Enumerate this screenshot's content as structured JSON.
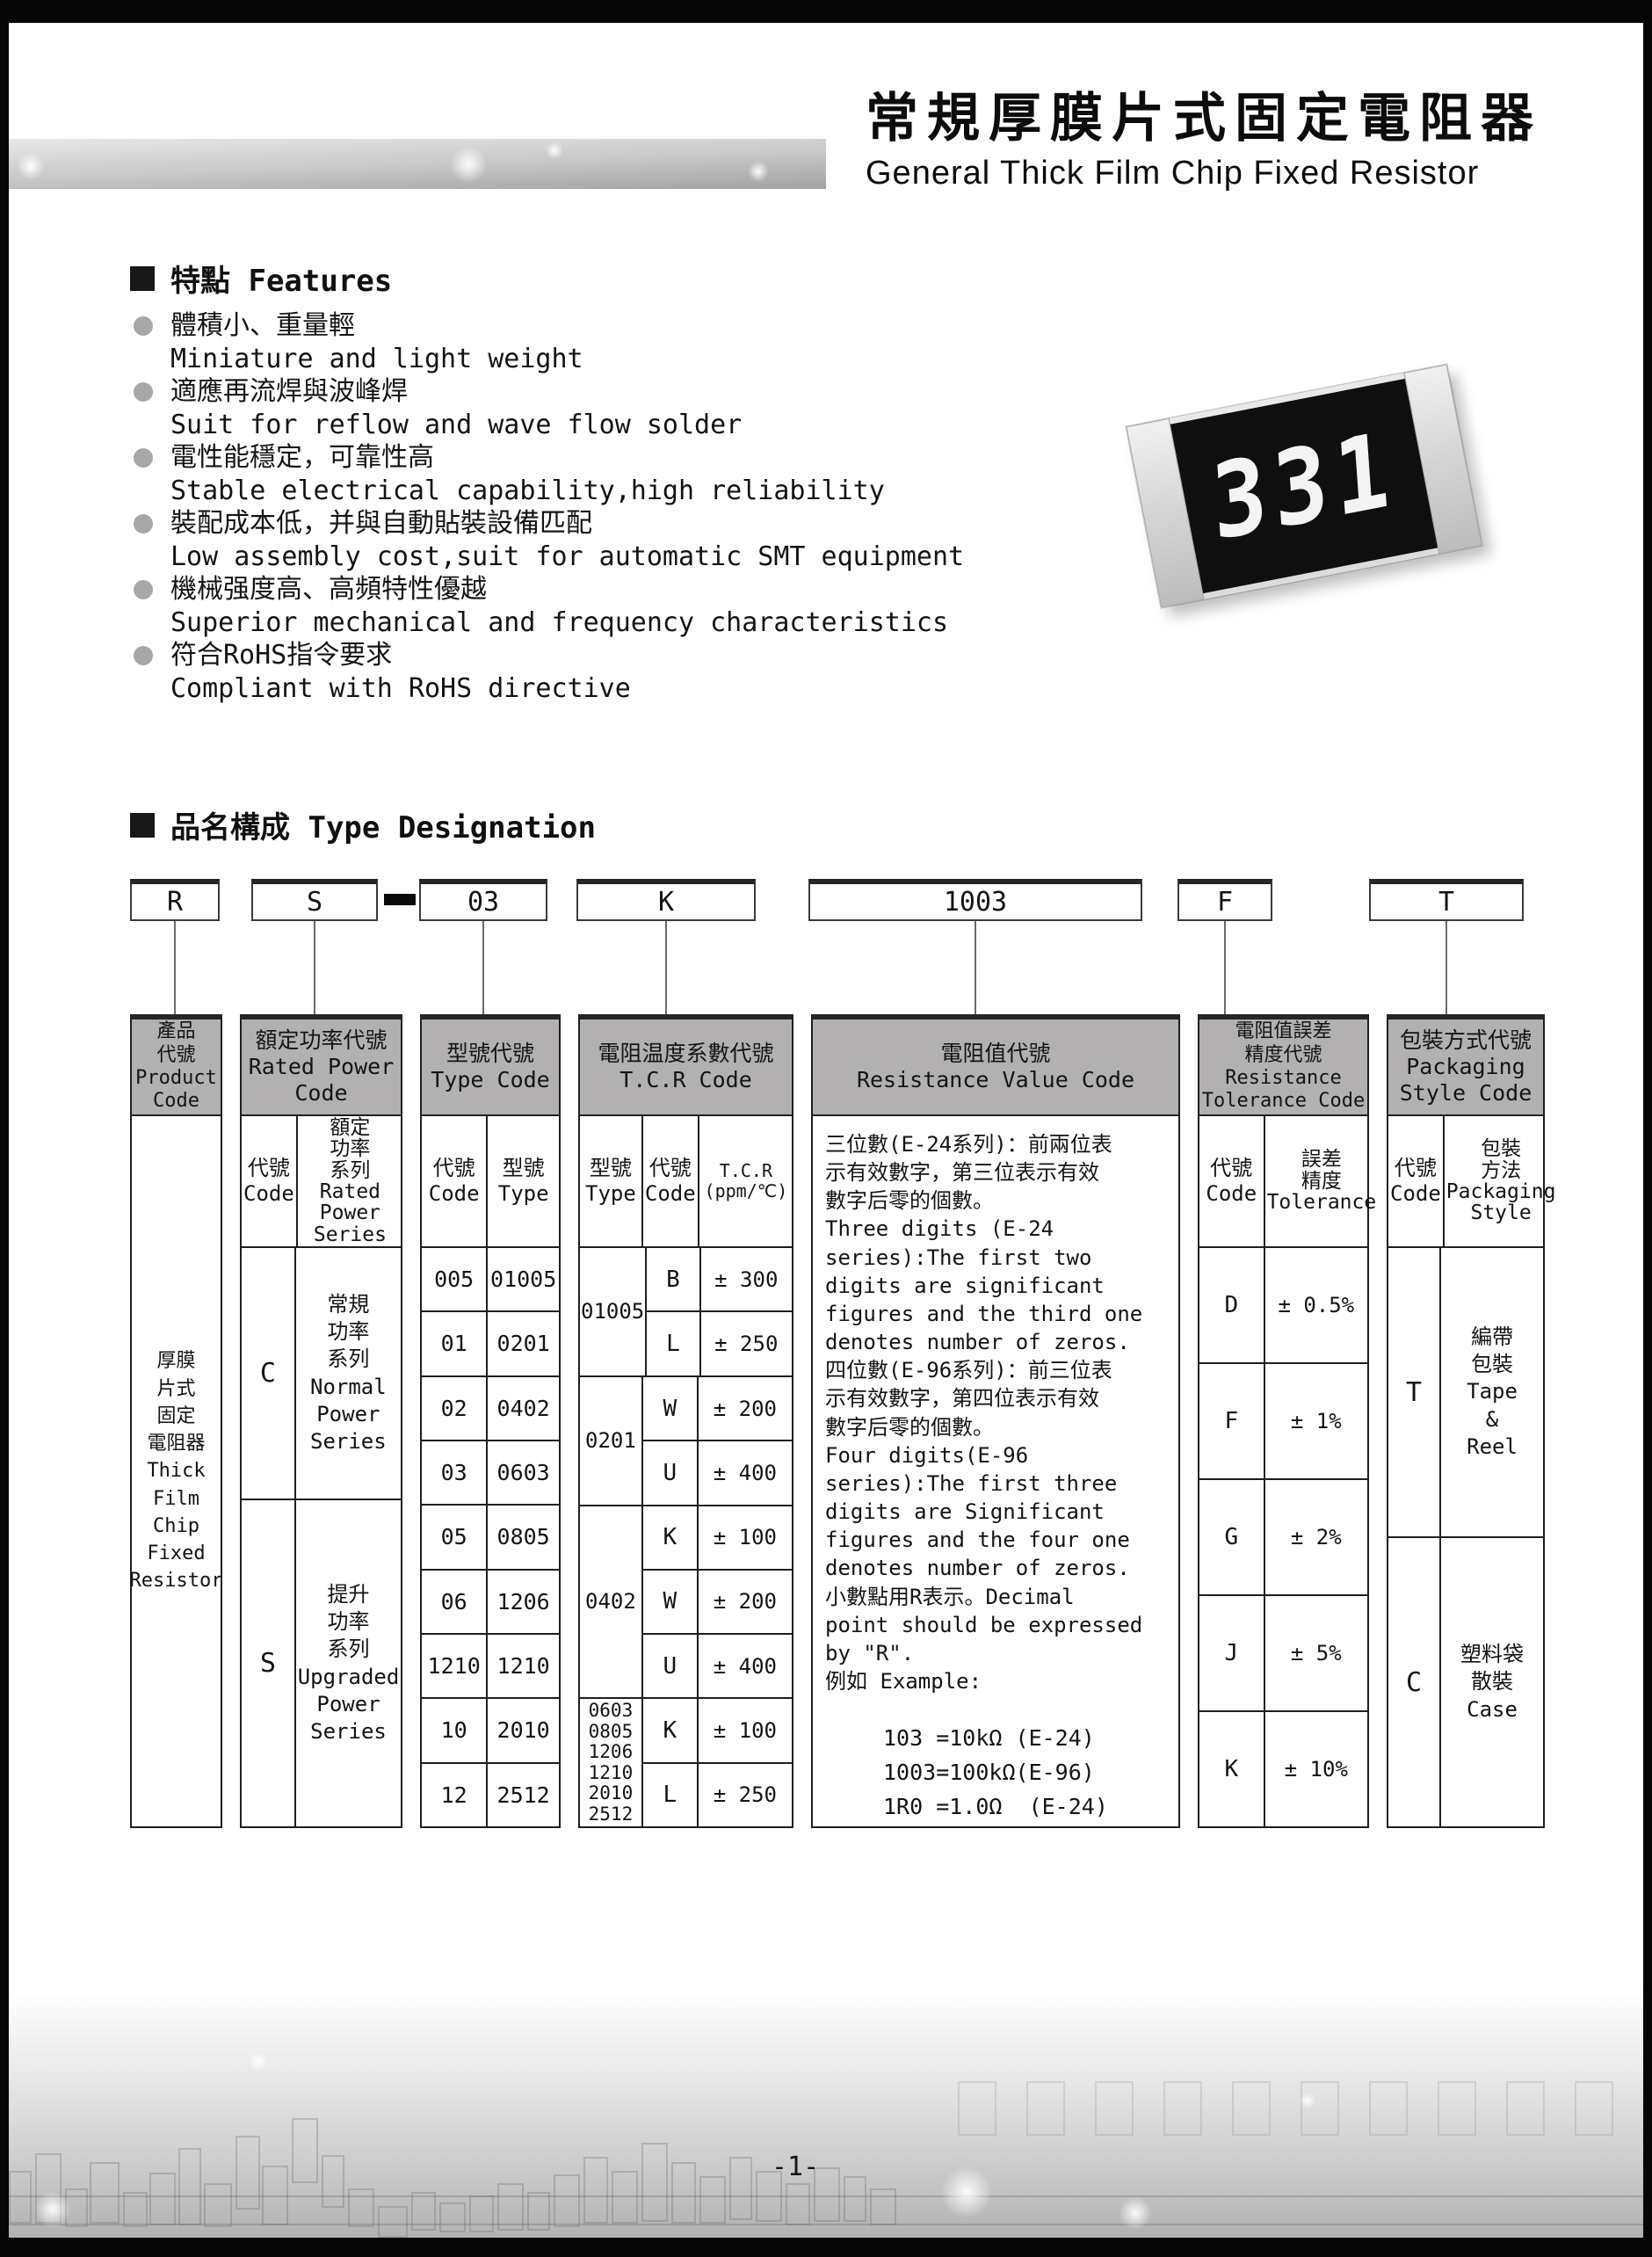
{
  "header": {
    "title_zh": "常規厚膜片式固定電阻器",
    "title_en": "General Thick Film Chip Fixed Resistor"
  },
  "features": {
    "title": "特點 Features",
    "items": [
      {
        "zh": "體積小、重量輕",
        "en": "Miniature and light weight"
      },
      {
        "zh": "適應再流焊與波峰焊",
        "en": "Suit for reflow and wave flow solder"
      },
      {
        "zh": "電性能穩定，可靠性高",
        "en": "Stable electrical capability,high reliability"
      },
      {
        "zh": "裝配成本低，并與自動貼裝設備匹配",
        "en": "Low assembly cost,suit for automatic SMT equipment"
      },
      {
        "zh": "機械强度高、高頻特性優越",
        "en": "Superior mechanical and frequency characteristics"
      },
      {
        "zh": "符合RoHS指令要求",
        "en": "Compliant with RoHS directive"
      }
    ]
  },
  "chip": {
    "marking": "331"
  },
  "designation": {
    "title": "品名構成  Type Designation",
    "codes": {
      "product": "R",
      "power": "S",
      "type": "03",
      "tcr": "K",
      "value": "1003",
      "tolerance": "F",
      "packaging": "T"
    }
  },
  "table": {
    "product": {
      "header": "產品\n代號\nProduct\nCode",
      "body": "厚膜\n片式\n固定\n電阻器\nThick\nFilm\nChip\nFixed\nResistor"
    },
    "power": {
      "header": "額定功率代號\nRated Power\nCode",
      "sub_code": "代號\nCode",
      "sub_series": "額定\n功率\n系列\nRated\nPower\nSeries",
      "rows": [
        {
          "code": "C",
          "series": "常規\n功率\n系列\nNormal\nPower\nSeries"
        },
        {
          "code": "S",
          "series": "提升\n功率\n系列\nUpgraded\nPower\nSeries"
        }
      ]
    },
    "type": {
      "header": "型號代號\nType Code",
      "sub_code": "代號\nCode",
      "sub_type": "型號\nType",
      "rows": [
        [
          "005",
          "01005"
        ],
        [
          "01",
          "0201"
        ],
        [
          "02",
          "0402"
        ],
        [
          "03",
          "0603"
        ],
        [
          "05",
          "0805"
        ],
        [
          "06",
          "1206"
        ],
        [
          "1210",
          "1210"
        ],
        [
          "10",
          "2010"
        ],
        [
          "12",
          "2512"
        ]
      ]
    },
    "tcr": {
      "header": "電阻温度系數代號\nT.C.R Code",
      "sub_type": "型號\nType",
      "sub_code": "代號\nCode",
      "sub_value": "T.C.R\n(ppm/℃)",
      "groups": [
        {
          "type": "01005",
          "rows": [
            [
              "B",
              "± 300"
            ],
            [
              "L",
              "± 250"
            ]
          ]
        },
        {
          "type": "0201",
          "rows": [
            [
              "W",
              "± 200"
            ],
            [
              "U",
              "± 400"
            ]
          ]
        },
        {
          "type": "0402",
          "rows": [
            [
              "K",
              "± 100"
            ],
            [
              "W",
              "± 200"
            ],
            [
              "U",
              "± 400"
            ]
          ]
        },
        {
          "type": "0603\n0805\n1206\n1210\n2010\n2512",
          "rows": [
            [
              "K",
              "± 100"
            ],
            [
              "L",
              "± 250"
            ]
          ]
        }
      ]
    },
    "value": {
      "header": "電阻值代號\nResistance Value Code",
      "text": "三位數(E-24系列)：前兩位表\n示有效數字，第三位表示有效\n數字后零的個數。\nThree digits (E-24\nseries):The first two\ndigits are significant\nfigures and the third one\ndenotes number of zeros.\n四位數(E-96系列)：前三位表\n示有效數字，第四位表示有效\n數字后零的個數。\nFour digits(E-96\nseries):The first three\ndigits are Significant\nfigures and the four one\ndenotes number of zeros.\n小數點用R表示。Decimal\npoint should be expressed\nby \"R\".\n例如 Example:",
      "examples": [
        "103 =10kΩ (E-24)",
        "1003=100kΩ(E-96)",
        "1R0 =1.0Ω  (E-24)"
      ]
    },
    "tolerance": {
      "header": "電阻值誤差\n精度代號\nResistance\nTolerance Code",
      "sub_code": "代號\nCode",
      "sub_value": "誤差\n精度\nTolerance",
      "rows": [
        [
          "D",
          "± 0.5%"
        ],
        [
          "F",
          "± 1%"
        ],
        [
          "G",
          "± 2%"
        ],
        [
          "J",
          "± 5%"
        ],
        [
          "K",
          "± 10%"
        ]
      ]
    },
    "packaging": {
      "header": "包裝方式代號\nPackaging\nStyle Code",
      "sub_code": "代號\nCode",
      "sub_style": "包裝\n方法\nPackaging\nStyle",
      "rows": [
        {
          "code": "T",
          "style": "編帶\n包裝\nTape\n&\nReel"
        },
        {
          "code": "C",
          "style": "塑料袋\n散裝\nCase"
        }
      ]
    }
  },
  "footer": {
    "page_number": "-1-"
  }
}
